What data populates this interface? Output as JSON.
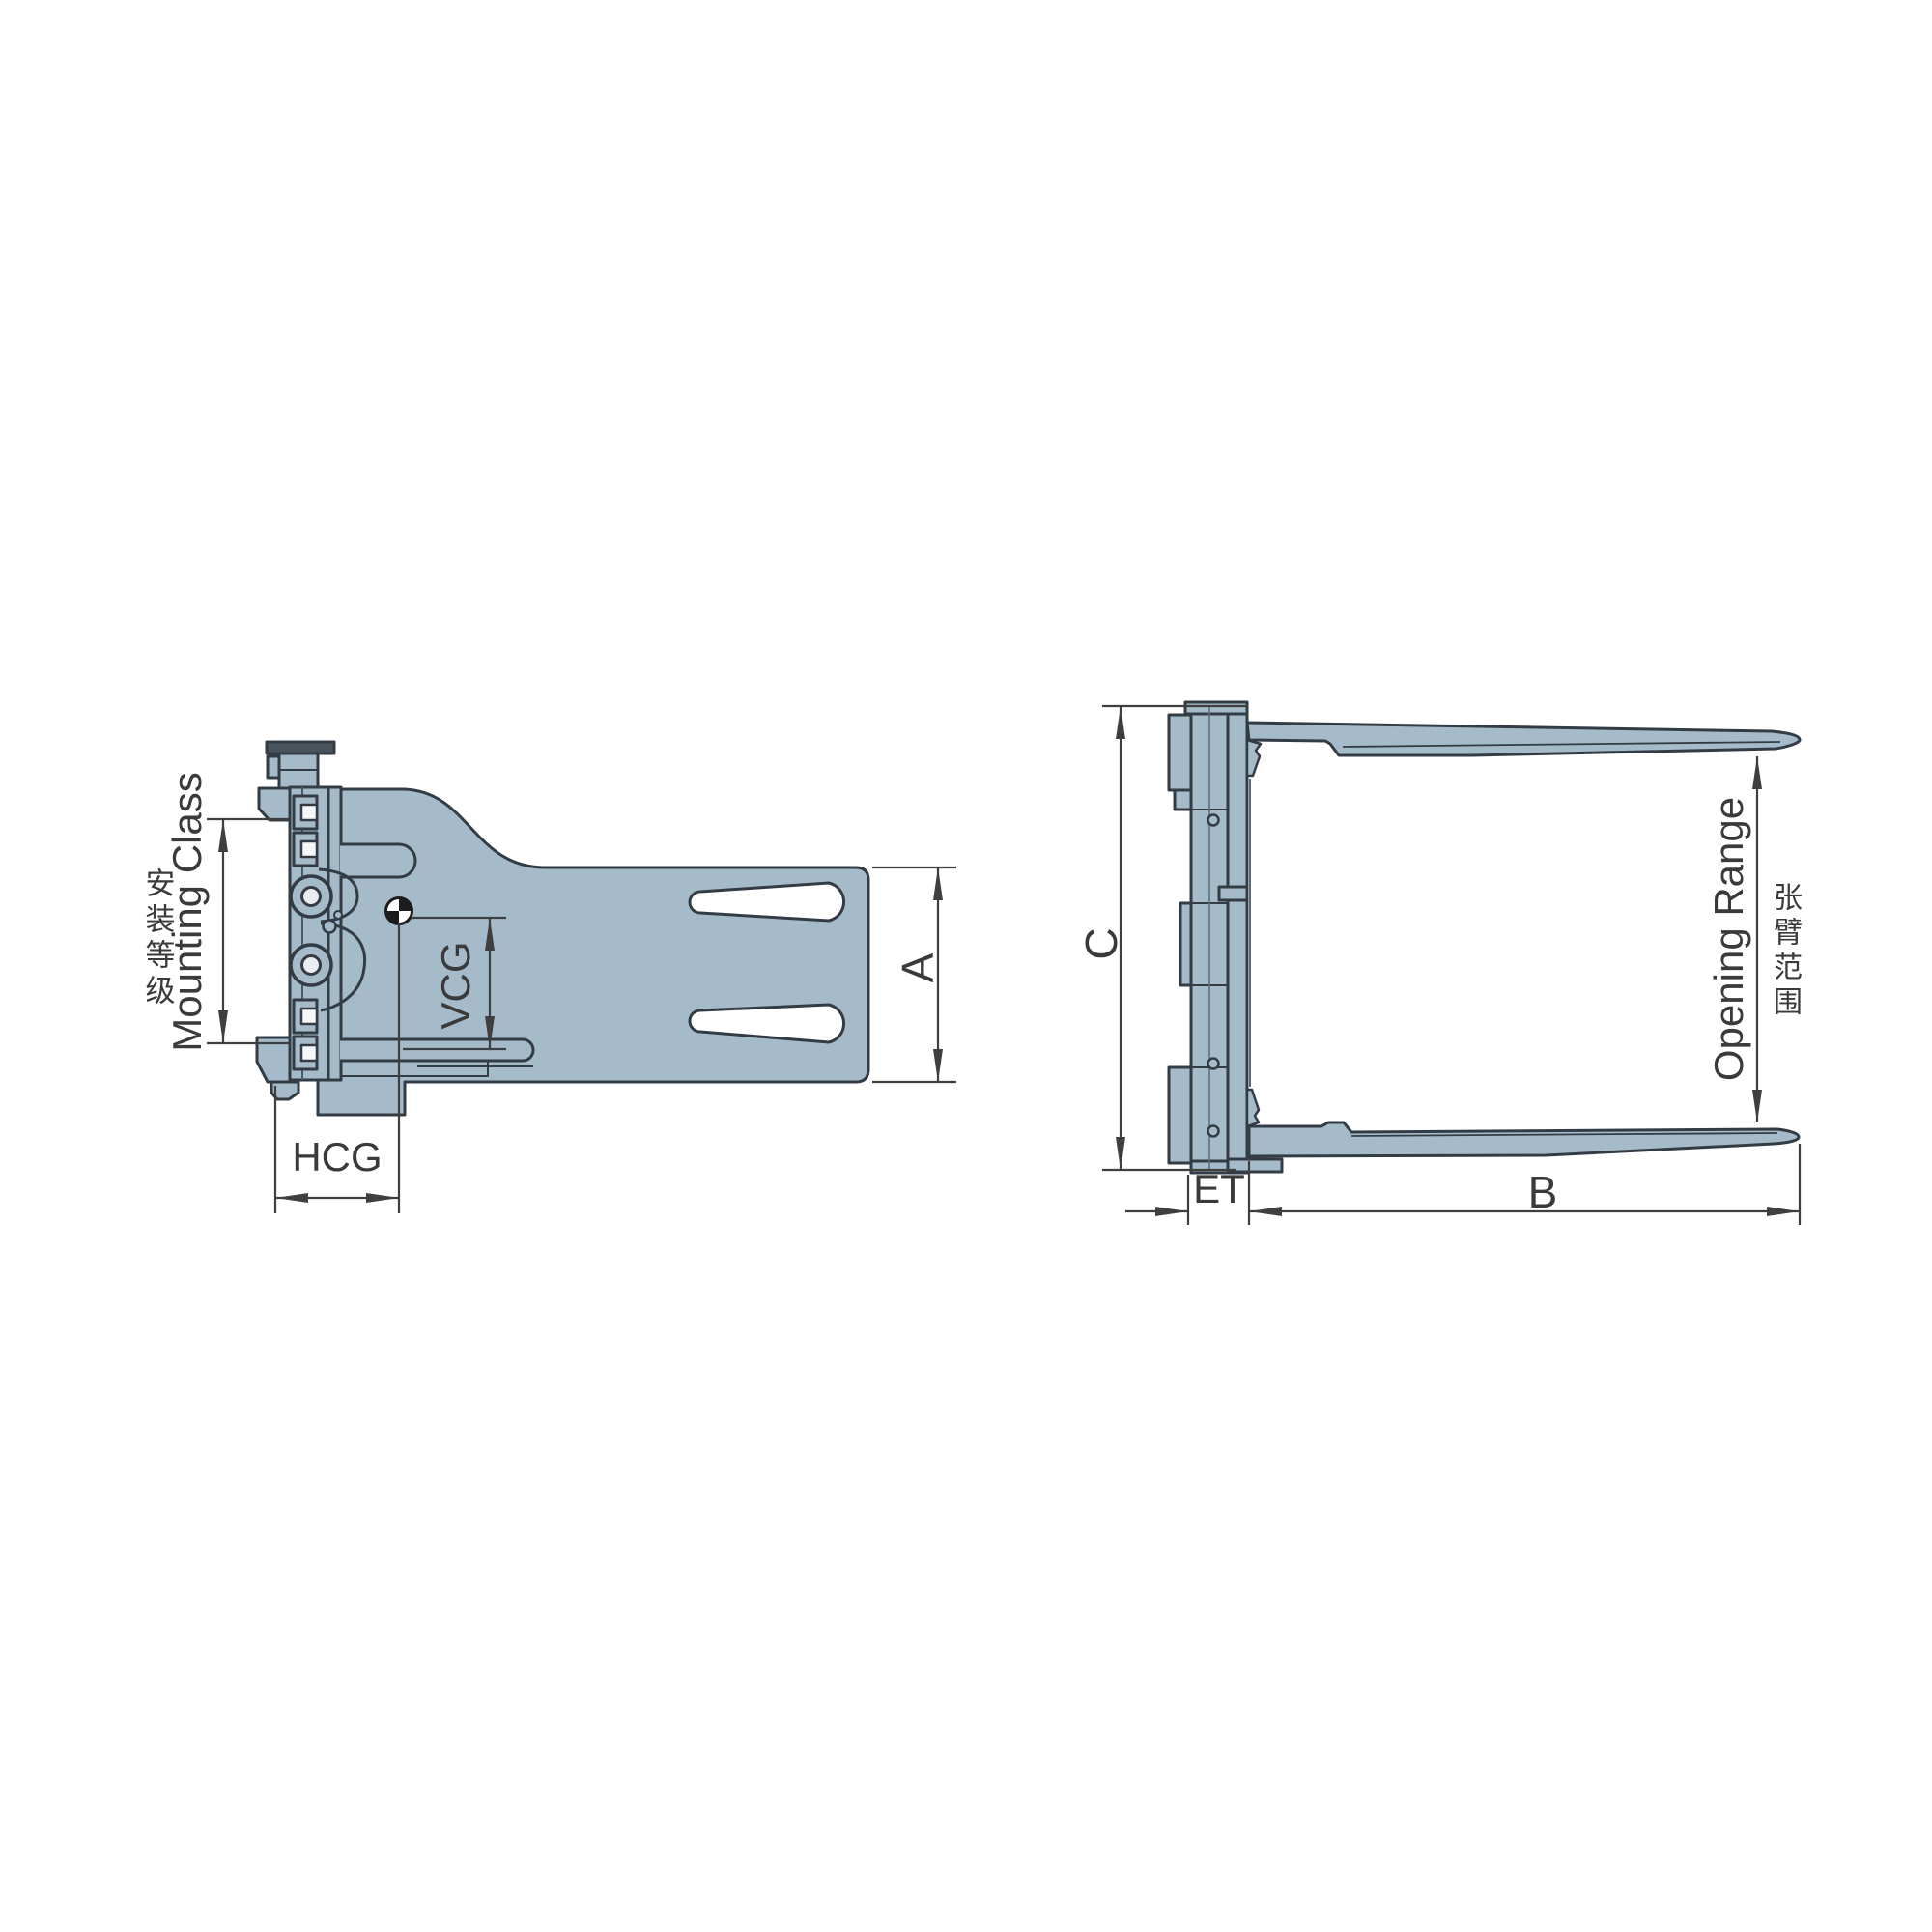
{
  "diagram": {
    "type": "engineering-drawing-forklift-bale-clamp",
    "views": {
      "side_view": {
        "labels": {
          "mounting_class_cn": "安装等级",
          "mounting_class": "Mounting Class",
          "vcg": "VCG",
          "hcg": "HCG",
          "height_a": "A"
        }
      },
      "front_view": {
        "labels": {
          "height_c": "C",
          "thickness_et": "ET",
          "arm_length_b": "B",
          "opening_range": "Opening Range",
          "opening_range_cn": "张臂范围"
        }
      }
    },
    "colors": {
      "part_fill": "#a6bbca",
      "outline": "#333c44",
      "dimension": "#3f3f3f"
    }
  }
}
